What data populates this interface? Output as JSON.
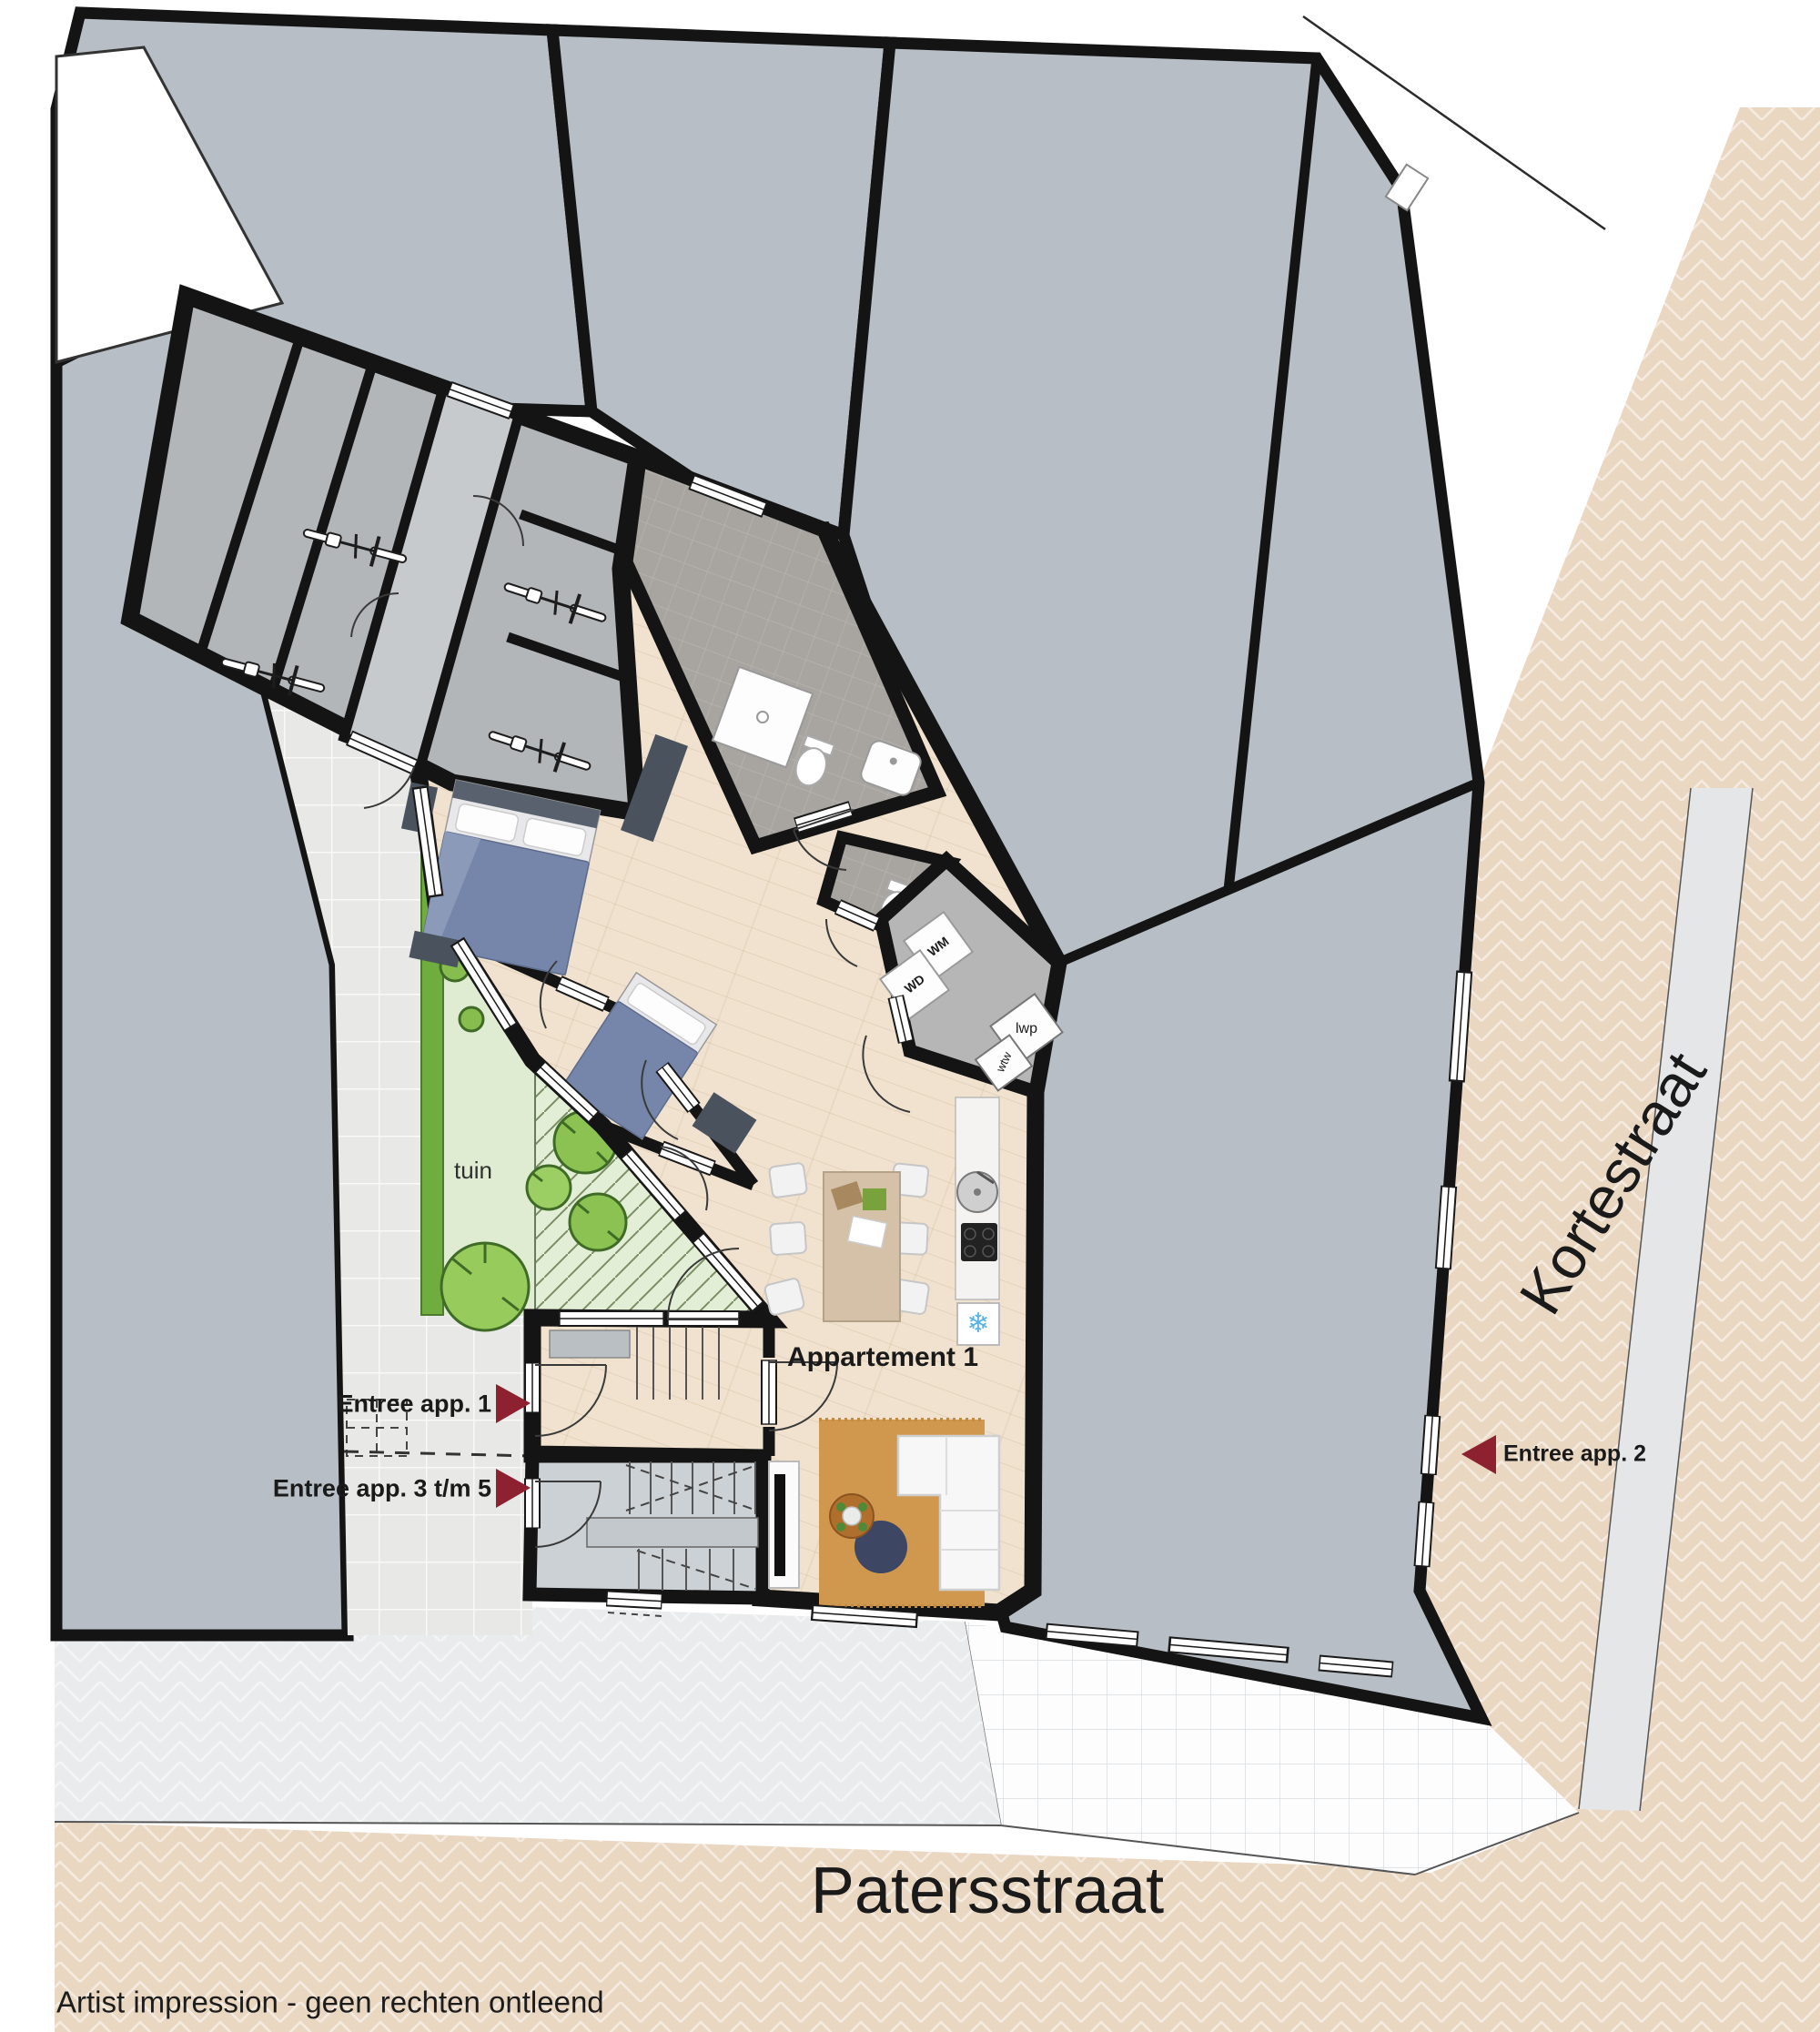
{
  "labels": {
    "garden": "tuin",
    "apartment": "Appartement 1",
    "entrance_app_1": "Entree app. 1",
    "entrance_app_3_5": "Entree app. 3 t/m 5",
    "entrance_app_2": "Entree app. 2",
    "wd": "WD",
    "wm": "WM",
    "lwp": "lwp",
    "wtw": "wtw",
    "street_bottom": "Patersstraat",
    "street_right": "Kortestraat",
    "disclaimer": "Artist impression - geen rechten ontleend"
  },
  "entrances": [
    {
      "label": "Entree app. 1",
      "arrow_direction": "right"
    },
    {
      "label": "Entree app. 3 t/m 5",
      "arrow_direction": "right"
    },
    {
      "label": "Entree app. 2",
      "arrow_direction": "left"
    }
  ],
  "icons": {
    "freezer_snowflake": "❄",
    "bicycle": "bike-top-view",
    "tree": "tree-canopy-circle"
  },
  "colors": {
    "wall": "#141414",
    "neighbor_building": "#b8bec6",
    "street_paving": "#ead7c2",
    "sidewalk_paving": "#e9ebec",
    "plaza_paving": "#fdfdfd",
    "path_tiles": "#e8e9e6",
    "lawn": "#dfecd2",
    "hedge": "#6fae3e",
    "terrace": "#e3eed6",
    "wood_floor": "#f0e2ce",
    "bath_tile": "#a8a5a1",
    "storage_floor": "#b3b6b9",
    "stairwell_floor": "#ccd1d5",
    "arrow_red": "#8e2130",
    "bed_blue": "#7686aa",
    "rug_orange": "#d0984f",
    "ottoman_navy": "#3d4662",
    "snowflake_blue": "#56b3e4"
  }
}
